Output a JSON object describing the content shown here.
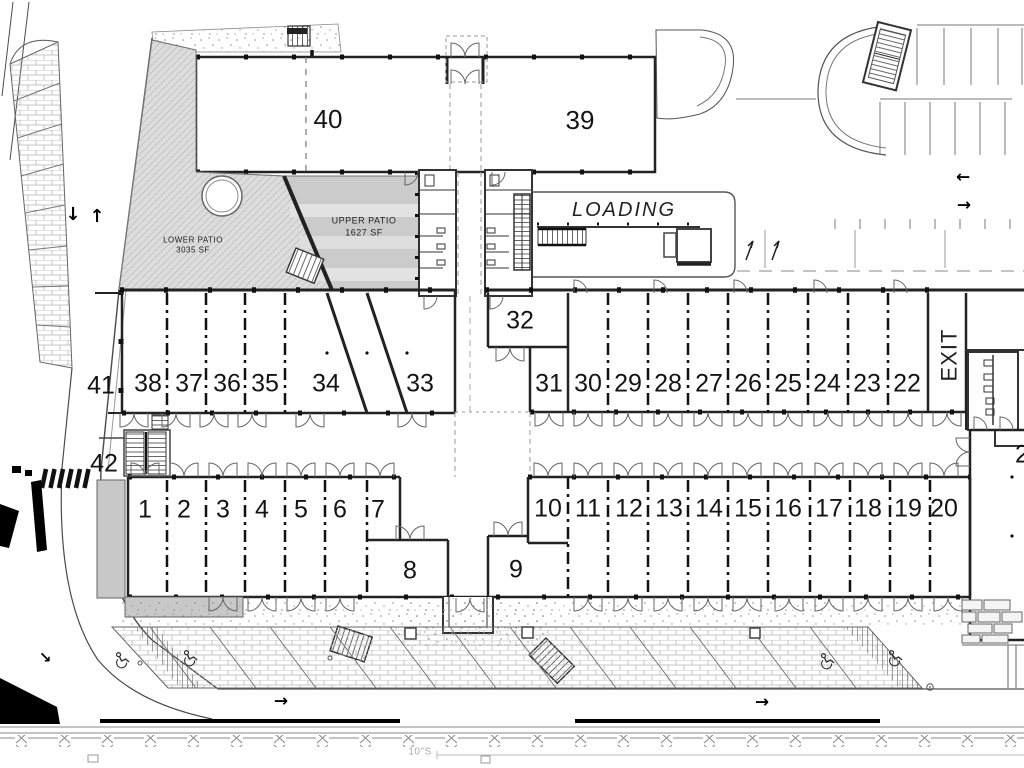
{
  "plan": {
    "kind": "architectural site / floor plan",
    "colors": {
      "line": "#4a4a4a",
      "wall": "#1f1f1f",
      "patio_fill": "#dcdcdc",
      "upper_patio_fill": "#cbcbcb",
      "shaded_fill": "#c8c8c8"
    },
    "units": [
      {
        "name": "unit-40",
        "label": "40",
        "x": 328,
        "y": 119,
        "size": 26
      },
      {
        "name": "unit-39",
        "label": "39",
        "x": 580,
        "y": 120,
        "size": 26
      },
      {
        "name": "unit-41",
        "label": "41",
        "x": 101,
        "y": 386
      },
      {
        "name": "unit-38",
        "label": "38",
        "x": 148,
        "y": 384
      },
      {
        "name": "unit-37",
        "label": "37",
        "x": 189,
        "y": 384
      },
      {
        "name": "unit-36",
        "label": "36",
        "x": 227,
        "y": 384
      },
      {
        "name": "unit-35",
        "label": "35",
        "x": 265,
        "y": 384
      },
      {
        "name": "unit-34",
        "label": "34",
        "x": 326,
        "y": 384
      },
      {
        "name": "unit-33",
        "label": "33",
        "x": 420,
        "y": 384
      },
      {
        "name": "unit-32",
        "label": "32",
        "x": 520,
        "y": 321
      },
      {
        "name": "unit-31",
        "label": "31",
        "x": 549,
        "y": 384
      },
      {
        "name": "unit-30",
        "label": "30",
        "x": 588,
        "y": 384
      },
      {
        "name": "unit-29",
        "label": "29",
        "x": 628,
        "y": 384
      },
      {
        "name": "unit-28",
        "label": "28",
        "x": 668,
        "y": 384
      },
      {
        "name": "unit-27",
        "label": "27",
        "x": 709,
        "y": 384
      },
      {
        "name": "unit-26",
        "label": "26",
        "x": 748,
        "y": 384
      },
      {
        "name": "unit-25",
        "label": "25",
        "x": 788,
        "y": 384
      },
      {
        "name": "unit-24",
        "label": "24",
        "x": 827,
        "y": 384
      },
      {
        "name": "unit-23",
        "label": "23",
        "x": 867,
        "y": 384
      },
      {
        "name": "unit-22",
        "label": "22",
        "x": 907,
        "y": 384
      },
      {
        "name": "unit-42",
        "label": "42",
        "x": 104,
        "y": 464
      },
      {
        "name": "unit-1",
        "label": "1",
        "x": 145,
        "y": 510
      },
      {
        "name": "unit-2",
        "label": "2",
        "x": 184,
        "y": 510
      },
      {
        "name": "unit-3",
        "label": "3",
        "x": 223,
        "y": 510
      },
      {
        "name": "unit-4",
        "label": "4",
        "x": 262,
        "y": 510
      },
      {
        "name": "unit-5",
        "label": "5",
        "x": 301,
        "y": 510
      },
      {
        "name": "unit-6",
        "label": "6",
        "x": 340,
        "y": 510
      },
      {
        "name": "unit-7",
        "label": "7",
        "x": 378,
        "y": 510
      },
      {
        "name": "unit-8",
        "label": "8",
        "x": 410,
        "y": 571
      },
      {
        "name": "unit-9",
        "label": "9",
        "x": 516,
        "y": 570
      },
      {
        "name": "unit-10",
        "label": "10",
        "x": 548,
        "y": 509
      },
      {
        "name": "unit-11",
        "label": "11",
        "x": 588,
        "y": 509
      },
      {
        "name": "unit-12",
        "label": "12",
        "x": 629,
        "y": 509
      },
      {
        "name": "unit-13",
        "label": "13",
        "x": 669,
        "y": 509
      },
      {
        "name": "unit-14",
        "label": "14",
        "x": 709,
        "y": 509
      },
      {
        "name": "unit-15",
        "label": "15",
        "x": 748,
        "y": 509
      },
      {
        "name": "unit-16",
        "label": "16",
        "x": 788,
        "y": 509
      },
      {
        "name": "unit-17",
        "label": "17",
        "x": 829,
        "y": 509
      },
      {
        "name": "unit-18",
        "label": "18",
        "x": 868,
        "y": 509
      },
      {
        "name": "unit-19",
        "label": "19",
        "x": 908,
        "y": 509
      },
      {
        "name": "unit-20",
        "label": "20",
        "x": 944,
        "y": 509
      },
      {
        "name": "unit-21-partial",
        "label": "2",
        "x": 1022,
        "y": 455
      }
    ],
    "areas": [
      {
        "name": "loading-zone-label",
        "label": "LOADING",
        "x": 624,
        "y": 210,
        "size": 20,
        "italic": true,
        "spacing": 2
      },
      {
        "name": "exit-corridor-label",
        "label": "EXIT",
        "x": 950,
        "y": 355,
        "size": 22,
        "rotate": -90,
        "spacing": 1
      },
      {
        "name": "lower-patio-label",
        "label": "LOWER PATIO",
        "sublabel": "3035 SF",
        "x": 193,
        "y": 246,
        "size": 8
      },
      {
        "name": "upper-patio-label",
        "label": "UPPER PATIO",
        "sublabel": "1627 SF",
        "x": 364,
        "y": 227,
        "size": 9
      },
      {
        "name": "sewer-line-label",
        "label": "10\"S",
        "x": 420,
        "y": 752,
        "size": 10,
        "color": "#aaaaaa"
      }
    ],
    "arrows": [
      {
        "name": "left-road-down-arrow",
        "glyph": "↓",
        "x": 73,
        "y": 215,
        "size": 18
      },
      {
        "name": "left-road-up-arrow",
        "glyph": "↑",
        "x": 97,
        "y": 217,
        "size": 18
      },
      {
        "name": "top-aisle-left-arrow",
        "glyph": "←",
        "x": 963,
        "y": 178,
        "size": 17
      },
      {
        "name": "top-aisle-right-arrow",
        "glyph": "→",
        "x": 964,
        "y": 206,
        "size": 17
      },
      {
        "name": "bottom-road-right-arrow-1",
        "glyph": "→",
        "x": 281,
        "y": 702,
        "size": 17
      },
      {
        "name": "bottom-road-right-arrow-2",
        "glyph": "→",
        "x": 762,
        "y": 703,
        "size": 17
      },
      {
        "name": "corner-curve-arrow",
        "glyph": "↘",
        "x": 45,
        "y": 658,
        "size": 15
      }
    ]
  }
}
